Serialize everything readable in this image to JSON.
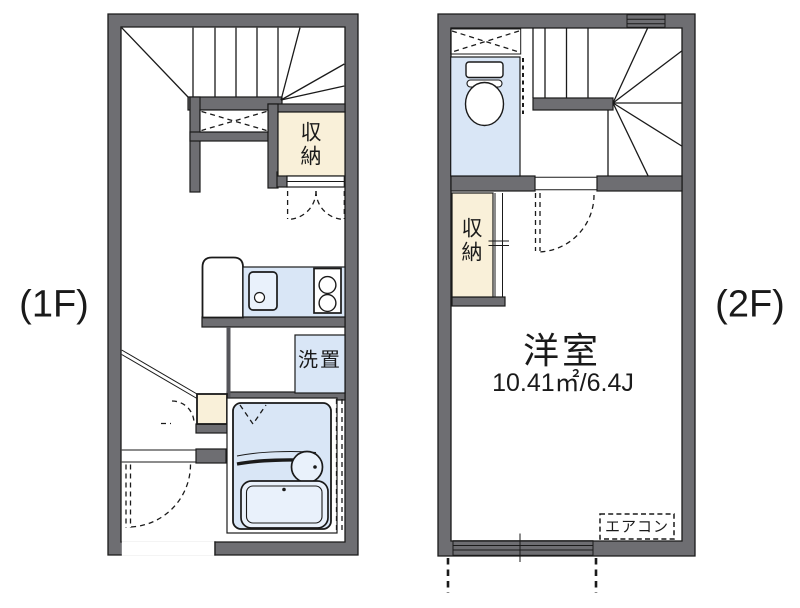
{
  "palette": {
    "wall_gray": "#6e6e72",
    "outline_black": "#1a1a1a",
    "closet_cream": "#f9f0d9",
    "water_blue": "#d9e6f6",
    "fixture_light_blue": "#e9f1fb",
    "paper_white": "#ffffff"
  },
  "floor1": {
    "label": "(1F)",
    "storage_label": "収納",
    "washer_label": "洗置"
  },
  "floor2": {
    "label": "(2F)",
    "storage_label": "収納",
    "room_label": "洋室",
    "room_area": "10.41㎡/6.4J",
    "aircon_label": "エアコン"
  }
}
